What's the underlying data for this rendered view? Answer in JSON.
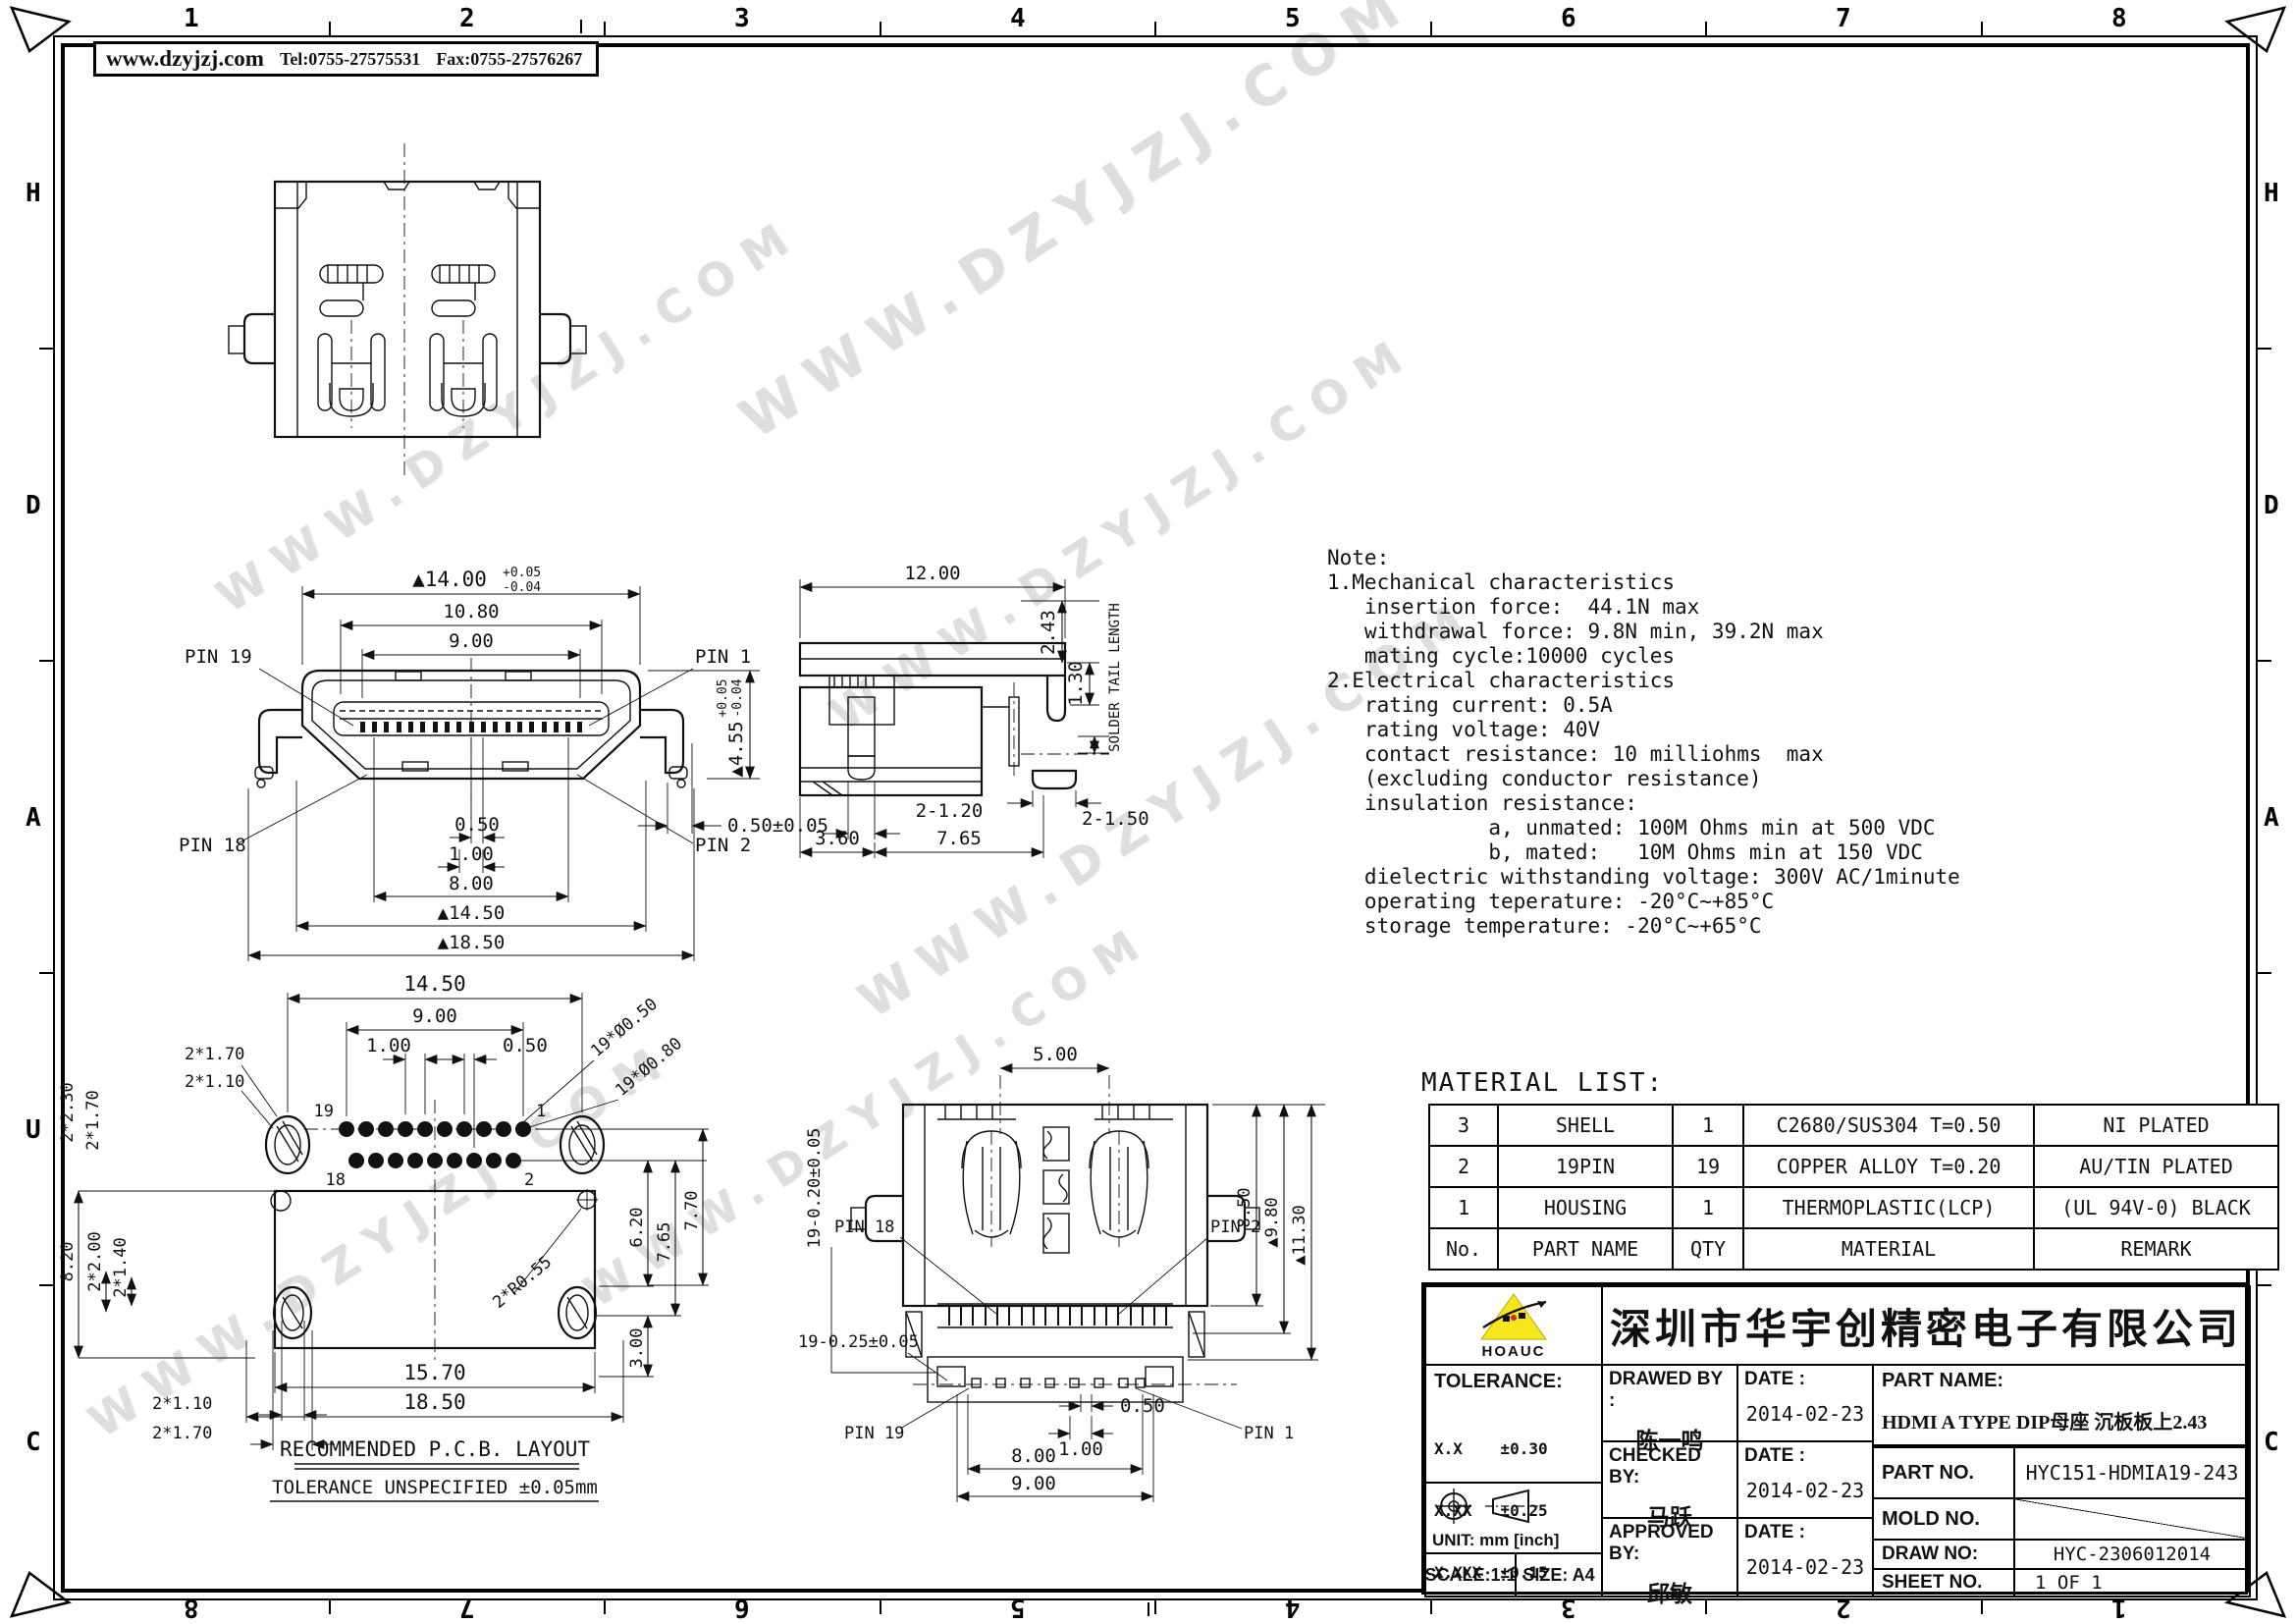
{
  "frame": {
    "cols": [
      "1",
      "2",
      "3",
      "4",
      "5",
      "6",
      "7",
      "8"
    ],
    "rows": [
      "H",
      "D",
      "A",
      "U",
      "C"
    ]
  },
  "header": {
    "website": "www.dzyjzj.com",
    "tel": "Tel:0755-27575531",
    "fax": "Fax:0755-27576267"
  },
  "watermark": {
    "text": "WWW.DZYJZJ.COM"
  },
  "notes": {
    "lines": [
      "Note:",
      "1.Mechanical characteristics",
      "   insertion force:  44.1N max",
      "   withdrawal force: 9.8N min, 39.2N max",
      "   mating cycle:10000 cycles",
      "2.Electrical characteristics",
      "   rating current: 0.5A",
      "   rating voltage: 40V",
      "   contact resistance: 10 milliohms  max",
      "   (excluding conductor resistance)",
      "   insulation resistance:",
      "             a, unmated: 100M Ohms min at 500 VDC",
      "             b, mated:   10M Ohms min at 150 VDC",
      "   dielectric withstanding voltage: 300V AC/1minute",
      "   operating teperature: -20°C~+85°C",
      "   storage temperature: -20°C~+65°C"
    ]
  },
  "material_list": {
    "title": "MATERIAL  LIST:",
    "col_no": "No.",
    "col_part": "PART  NAME",
    "col_qty": "QTY",
    "col_material": "MATERIAL",
    "col_remark": "REMARK",
    "rows": [
      {
        "no": "3",
        "part": "SHELL",
        "qty": "1",
        "material": "C2680/SUS304  T=0.50",
        "remark": "NI  PLATED"
      },
      {
        "no": "2",
        "part": "19PIN",
        "qty": "19",
        "material": "COPPER  ALLOY  T=0.20",
        "remark": "AU/TIN  PLATED"
      },
      {
        "no": "1",
        "part": "HOUSING",
        "qty": "1",
        "material": "THERMOPLASTIC(LCP)",
        "remark": "(UL  94V-0)  BLACK"
      }
    ]
  },
  "title_block": {
    "company": "深圳市华宇创精密电子有限公司",
    "logo_text": "HOAUC",
    "tolerance_label": "TOLERANCE:",
    "tol1": "X.X    ±0.30",
    "tol2": "X.XX   ±0.25",
    "tol3": "X.XXX  ±0.15",
    "tol_angle": "X.° ±2°    X.X° ±0.5°",
    "unit": "UNIT:  mm  [inch]",
    "scale": "SCALE:1:1",
    "size": "SIZE:  A4",
    "drawed_label": "DRAWED BY :",
    "drawed_name": "陈一鸣",
    "checked_label": "CHECKED  BY:",
    "checked_name": "马跃",
    "approved_label": "APPROVED  BY:",
    "approved_name": "邱敏",
    "date_label": "DATE :",
    "date1": "2014-02-23",
    "date2": "2014-02-23",
    "date3": "2014-02-23",
    "part_name_label": "PART  NAME:",
    "part_name": "HDMI A TYPE DIP母座 沉板板上2.43",
    "part_no_label": "PART  NO.",
    "part_no": "HYC151-HDMIA19-243",
    "mold_no_label": "MOLD  NO.",
    "mold_no": "",
    "draw_no_label": "DRAW  NO:",
    "draw_no": "HYC-2306012014",
    "sheet_no_label": "SHEET  NO.",
    "sheet_no": "1 OF 1",
    "accent_yellow": "#f6e71d",
    "accent_red": "#cc2222"
  },
  "front_view": {
    "pin19": "PIN 19",
    "pin1": "PIN 1",
    "pin18": "PIN 18",
    "pin2": "PIN 2",
    "d1400": "▲14.00",
    "d1400_tp": "+0.05",
    "d1400_tm": "-0.04",
    "d1080": "10.80",
    "d900": "9.00",
    "d455": "▲4.55",
    "d455_tp": "+0.05",
    "d455_tm": "-0.04",
    "d050tol": "0.50±0.05",
    "d050": "0.50",
    "d100": "1.00",
    "d800": "8.00",
    "d1450": "▲14.50",
    "d1850": "▲18.50"
  },
  "side_view": {
    "d1200": "12.00",
    "d243": "2.43",
    "d130": "1.30",
    "solder": "SOLDER TAIL LENGTH",
    "d2120": "2-1.20",
    "d2150": "2-1.50",
    "d360": "3.60",
    "d765": "7.65"
  },
  "pcb_view": {
    "d1450": "14.50",
    "d900": "9.00",
    "d100": "1.00",
    "d050": "0.50",
    "d230": "2*2.30",
    "d170v": "2*1.70",
    "d170h": "2*1.70",
    "d110h": "2*1.10",
    "d820": "8.20",
    "d200": "2*2.00",
    "d140": "2*1.40",
    "d110b": "2*1.10",
    "d170b": "2*1.70",
    "d1570": "15.70",
    "d1850": "18.50",
    "d620": "6.20",
    "d765": "7.65",
    "d770": "7.70",
    "d300": "3.00",
    "hole050": "19*Ø0.50",
    "hole080": "19*Ø0.80",
    "r055": "2*R0.55",
    "p19": "19",
    "p1": "1",
    "p18": "18",
    "p2": "2",
    "caption1": "RECOMMENDED    P.C.B.  LAYOUT",
    "caption2": "TOLERANCE  UNSPECIFIED  ±0.05mm"
  },
  "back_view": {
    "d500": "5.00",
    "left_dim": "19-0.20±0.05",
    "d850": "8.50",
    "d980": "▲9.80",
    "d1130": "▲11.30",
    "bottom_dim": "19-0.25±0.05",
    "d050": "0.50",
    "d100": "1.00",
    "d800": "8.00",
    "d900": "9.00",
    "pin18": "PIN 18",
    "pin2": "PIN 2",
    "pin19": "PIN 19",
    "pin1": "PIN 1"
  }
}
